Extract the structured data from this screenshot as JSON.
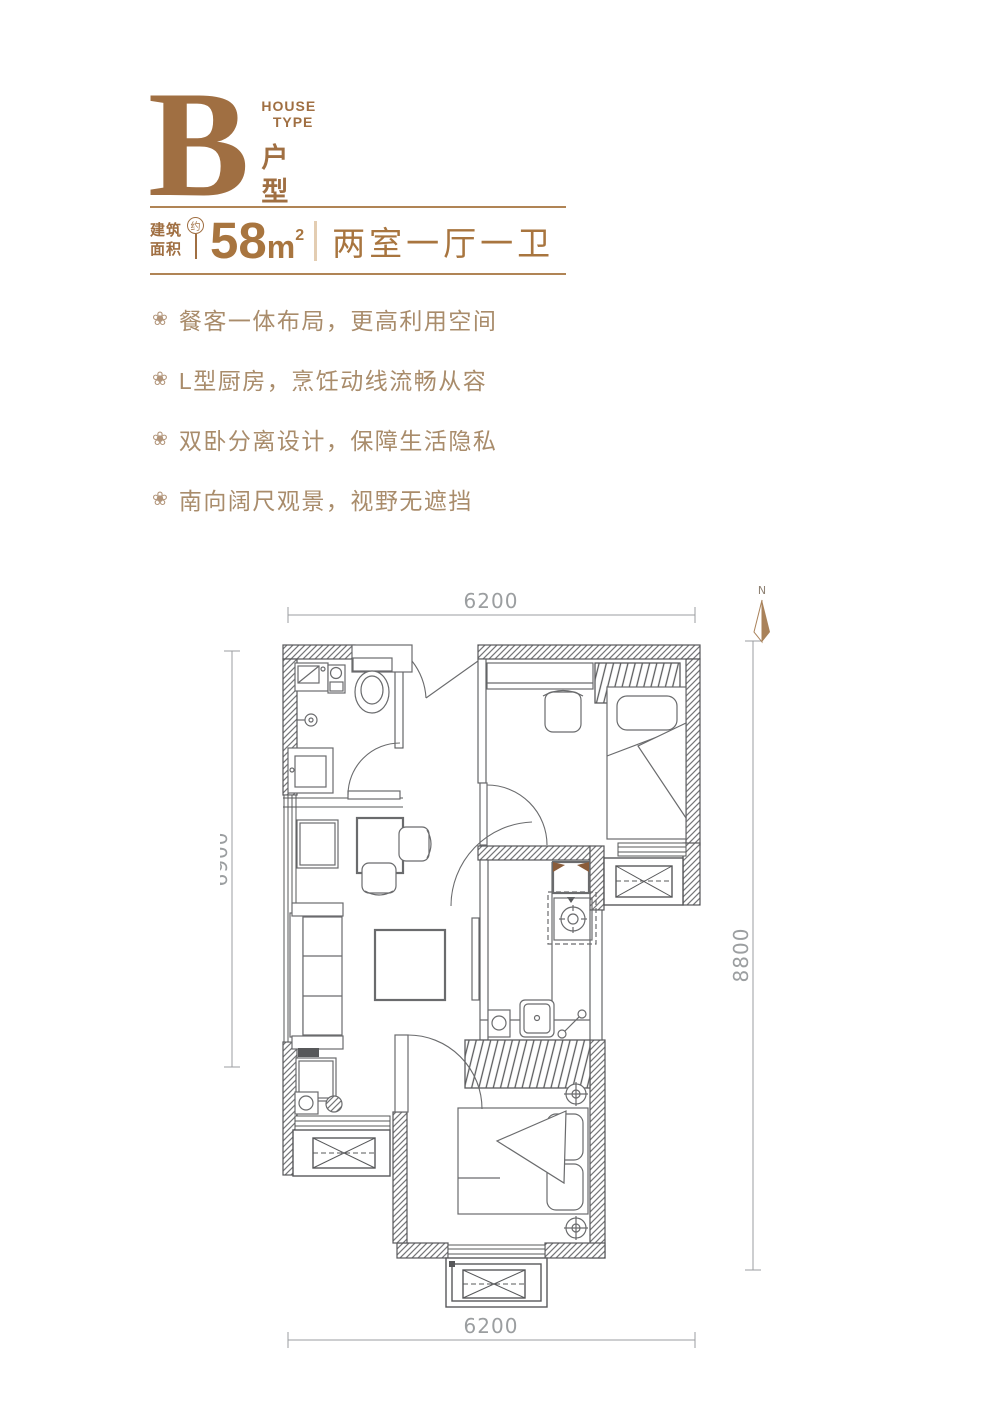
{
  "header": {
    "letter": "B",
    "subtitle_en_line1": "HOUSE",
    "subtitle_en_line2": "TYPE",
    "subtitle_cn_char1": "户",
    "subtitle_cn_char2": "型"
  },
  "area": {
    "label_line1": "建筑",
    "label_line2": "面积",
    "approx_badge": "约",
    "value": "58",
    "unit": "m",
    "unit_sup": "2",
    "layout": "两室一厅一卫"
  },
  "features": [
    {
      "icon": "flower-icon",
      "glyph": "❀",
      "text": "餐客一体布局，更高利用空间"
    },
    {
      "icon": "flower-icon",
      "glyph": "❀",
      "text": "L型厨房，烹饪动线流畅从容"
    },
    {
      "icon": "flower-icon",
      "glyph": "❀",
      "text": "双卧分离设计，保障生活隐私"
    },
    {
      "icon": "flower-icon",
      "glyph": "❀",
      "text": "南向阔尺观景，视野无遮挡"
    }
  ],
  "floorplan": {
    "compass_label": "N",
    "dimensions": {
      "top": "6200",
      "left": "6900",
      "right": "8800",
      "bottom": "6200"
    }
  },
  "colors": {
    "brand_brown": "#a06f42",
    "value_brown": "#a8753f",
    "accent_tan": "#a98c6b",
    "dimension_gray": "#9b9ea0",
    "wall_gray": "#57585a",
    "compass_brown": "#a9825a"
  }
}
